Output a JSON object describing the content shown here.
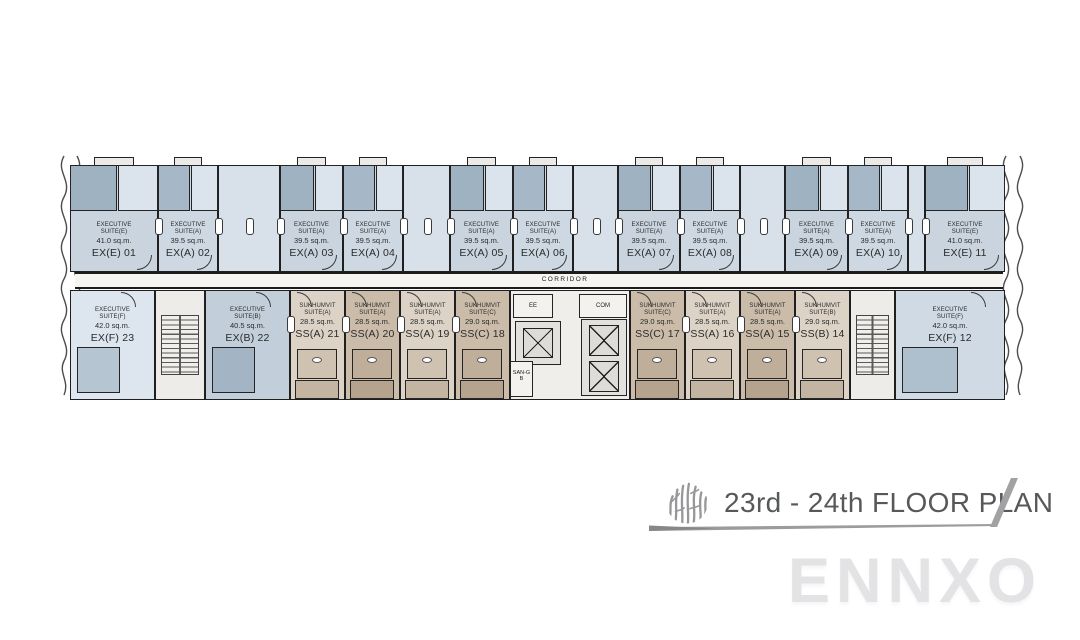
{
  "plan": {
    "corridor_label": "CORRIDOR",
    "core": {
      "ee": "EE",
      "com": "COM",
      "san": "SAN-GB"
    },
    "top_row": {
      "units": [
        {
          "kind": "exec",
          "t1": "EXECUTIVE",
          "t2": "SUITE(E)",
          "area": "41.0 sq.m.",
          "code": "EX(E) 01",
          "x": 70,
          "w": 88,
          "fill": "#c9d4df",
          "dark": "#9fb2c2",
          "lite": "#dbe4ec"
        },
        {
          "kind": "exec",
          "t1": "EXECUTIVE",
          "t2": "SUITE(A)",
          "area": "39.5 sq.m.",
          "code": "EX(A) 02",
          "x": 158,
          "w": 60,
          "fill": "#cdd8e2",
          "dark": "#a6b8c7",
          "lite": "#dbe4ec"
        },
        {
          "kind": "shaft",
          "x": 218,
          "w": 62,
          "fill": "#d8e1ea"
        },
        {
          "kind": "exec",
          "t1": "EXECUTIVE",
          "t2": "SUITE(A)",
          "area": "39.5 sq.m.",
          "code": "EX(A) 03",
          "x": 280,
          "w": 63,
          "fill": "#c9d4df",
          "dark": "#9fb2c2",
          "lite": "#dbe4ec"
        },
        {
          "kind": "exec",
          "t1": "EXECUTIVE",
          "t2": "SUITE(A)",
          "area": "39.5 sq.m.",
          "code": "EX(A) 04",
          "x": 343,
          "w": 60,
          "fill": "#cdd8e2",
          "dark": "#a6b8c7",
          "lite": "#dbe4ec"
        },
        {
          "kind": "shaft",
          "x": 403,
          "w": 47,
          "fill": "#d8e1ea"
        },
        {
          "kind": "exec",
          "t1": "EXECUTIVE",
          "t2": "SUITE(A)",
          "area": "39.5 sq.m.",
          "code": "EX(A) 05",
          "x": 450,
          "w": 63,
          "fill": "#c9d4df",
          "dark": "#9fb2c2",
          "lite": "#dbe4ec"
        },
        {
          "kind": "exec",
          "t1": "EXECUTIVE",
          "t2": "SUITE(A)",
          "area": "39.5 sq.m.",
          "code": "EX(A) 06",
          "x": 513,
          "w": 60,
          "fill": "#cdd8e2",
          "dark": "#a6b8c7",
          "lite": "#dbe4ec"
        },
        {
          "kind": "shaft",
          "x": 573,
          "w": 45,
          "fill": "#d8e1ea"
        },
        {
          "kind": "exec",
          "t1": "EXECUTIVE",
          "t2": "SUITE(A)",
          "area": "39.5 sq.m.",
          "code": "EX(A) 07",
          "x": 618,
          "w": 62,
          "fill": "#c9d4df",
          "dark": "#9fb2c2",
          "lite": "#dbe4ec"
        },
        {
          "kind": "exec",
          "t1": "EXECUTIVE",
          "t2": "SUITE(A)",
          "area": "39.5 sq.m.",
          "code": "EX(A) 08",
          "x": 680,
          "w": 60,
          "fill": "#cdd8e2",
          "dark": "#a6b8c7",
          "lite": "#dbe4ec"
        },
        {
          "kind": "shaft",
          "x": 740,
          "w": 45,
          "fill": "#d8e1ea"
        },
        {
          "kind": "exec",
          "t1": "EXECUTIVE",
          "t2": "SUITE(A)",
          "area": "39.5 sq.m.",
          "code": "EX(A) 09",
          "x": 785,
          "w": 63,
          "fill": "#c9d4df",
          "dark": "#9fb2c2",
          "lite": "#dbe4ec"
        },
        {
          "kind": "exec",
          "t1": "EXECUTIVE",
          "t2": "SUITE(A)",
          "area": "39.5 sq.m.",
          "code": "EX(A) 10",
          "x": 848,
          "w": 60,
          "fill": "#cdd8e2",
          "dark": "#a6b8c7",
          "lite": "#dbe4ec"
        },
        {
          "kind": "shaft",
          "x": 908,
          "w": 17,
          "fill": "#d8e1ea"
        },
        {
          "kind": "exec",
          "t1": "EXECUTIVE",
          "t2": "SUITE(E)",
          "area": "41.0 sq.m.",
          "code": "EX(E) 11",
          "x": 925,
          "w": 80,
          "fill": "#c9d4df",
          "dark": "#9fb2c2",
          "lite": "#dbe4ec"
        }
      ]
    },
    "bottom_row": {
      "units": [
        {
          "kind": "exec",
          "t1": "EXECUTIVE",
          "t2": "SUITE(F)",
          "area": "42.0 sq.m.",
          "code": "EX(F) 23",
          "x": 70,
          "w": 85,
          "fill": "#dde6ee",
          "dark": "#b6c5d2"
        },
        {
          "kind": "stair",
          "x": 155,
          "w": 50
        },
        {
          "kind": "exec",
          "t1": "EXECUTIVE",
          "t2": "SUITE(B)",
          "area": "40.5 sq.m.",
          "code": "EX(B) 22",
          "x": 205,
          "w": 85,
          "fill": "#c2cfda",
          "dark": "#a3b5c4"
        },
        {
          "kind": "ss",
          "t1": "SUKHUMVIT",
          "t2": "SUITE(A)",
          "area": "28.5 sq.m.",
          "code": "SS(A) 21",
          "x": 290,
          "w": 55,
          "fill": "#dcd3c6",
          "bath": "#cfc2b1",
          "balc": "#c4b5a2"
        },
        {
          "kind": "ss",
          "t1": "SUKHUMVIT",
          "t2": "SUITE(A)",
          "area": "28.5 sq.m.",
          "code": "SS(A) 20",
          "x": 345,
          "w": 55,
          "fill": "#cbbcaa",
          "bath": "#bfae99",
          "balc": "#b5a38d"
        },
        {
          "kind": "ss",
          "t1": "SUKHUMVIT",
          "t2": "SUITE(A)",
          "area": "28.5 sq.m.",
          "code": "SS(A) 19",
          "x": 400,
          "w": 55,
          "fill": "#dcd3c6",
          "bath": "#cfc2b1",
          "balc": "#c4b5a2"
        },
        {
          "kind": "ss",
          "t1": "SUKHUMVIT",
          "t2": "SUITE(C)",
          "area": "29.0 sq.m.",
          "code": "SS(C) 18",
          "x": 455,
          "w": 55,
          "fill": "#cbbcaa",
          "bath": "#bfae99",
          "balc": "#b5a38d"
        },
        {
          "kind": "core",
          "x": 510,
          "w": 120
        },
        {
          "kind": "ss",
          "t1": "SUKHUMVIT",
          "t2": "SUITE(C)",
          "area": "29.0 sq.m.",
          "code": "SS(C) 17",
          "x": 630,
          "w": 55,
          "fill": "#cbbcaa",
          "bath": "#bfae99",
          "balc": "#b5a38d"
        },
        {
          "kind": "ss",
          "t1": "SUKHUMVIT",
          "t2": "SUITE(A)",
          "area": "28.5 sq.m.",
          "code": "SS(A) 16",
          "x": 685,
          "w": 55,
          "fill": "#dcd3c6",
          "bath": "#cfc2b1",
          "balc": "#c4b5a2"
        },
        {
          "kind": "ss",
          "t1": "SUKHUMVIT",
          "t2": "SUITE(A)",
          "area": "28.5 sq.m.",
          "code": "SS(A) 15",
          "x": 740,
          "w": 55,
          "fill": "#cbbcaa",
          "bath": "#bfae99",
          "balc": "#b5a38d"
        },
        {
          "kind": "ss",
          "t1": "SUKHUMVIT",
          "t2": "SUITE(B)",
          "area": "29.0 sq.m.",
          "code": "SS(B) 14",
          "x": 795,
          "w": 55,
          "fill": "#dcd3c6",
          "bath": "#cfc2b1",
          "balc": "#c4b5a2"
        },
        {
          "kind": "stair",
          "x": 850,
          "w": 45
        },
        {
          "kind": "exec",
          "t1": "EXECUTIVE",
          "t2": "SUITE(F)",
          "area": "42.0 sq.m.",
          "code": "EX(F) 12",
          "x": 895,
          "w": 110,
          "fill": "#cfdae4",
          "dark": "#aebfcd"
        }
      ]
    }
  },
  "title_block": {
    "text": "23rd - 24th FLOOR PLAN"
  },
  "watermark": "ENNXO",
  "colors": {
    "wall": "#1f1f1f",
    "exec_fill": "#c9d4df",
    "exec_fill_alt": "#cdd8e2",
    "shaft_fill": "#d8e1ea",
    "ss_light": "#dcd3c6",
    "ss_dark": "#cbbcaa",
    "core_fill": "#efeeea",
    "title_text": "#57585a",
    "logo_gray": "#97979a",
    "watermark_gray": "#e3e3e5"
  }
}
